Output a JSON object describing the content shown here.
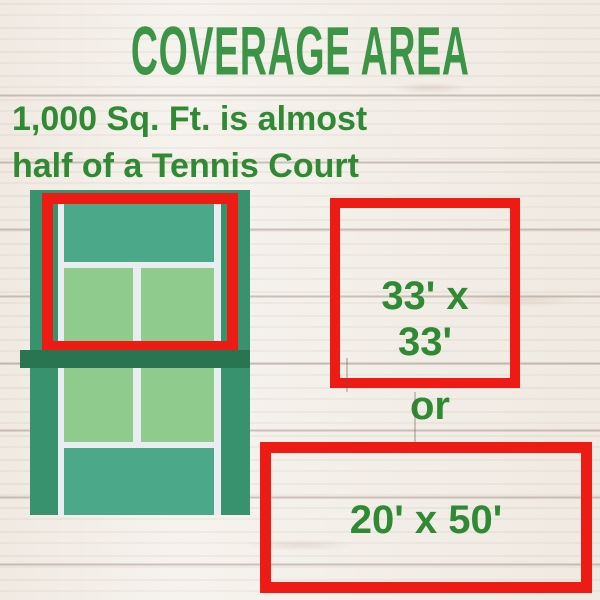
{
  "page": {
    "title": "COVERAGE AREA",
    "subtitle_line1": "1,000 Sq. Ft. is almost",
    "subtitle_line2": "half of a Tennis Court"
  },
  "comparison": {
    "square_label_line1": "33' x",
    "square_label_line2": "33'",
    "connector": "or",
    "rect_label": "20' x 50'"
  },
  "illustration": {
    "name": "tennis-court-top-view",
    "highlighted_region": "top half of court outlined in red"
  },
  "colors": {
    "title_green": "#3c9547",
    "text_green": "#2f8a33",
    "highlight_red": "#ee1b15",
    "court_base_green": "#38926e",
    "court_net_green": "#2a7551",
    "court_backcourt_teal": "#4ba98a",
    "court_service_box_green": "#8ecb8c",
    "court_line_white": "#e9edf0",
    "background_wood_white": "#f6f3ee"
  }
}
